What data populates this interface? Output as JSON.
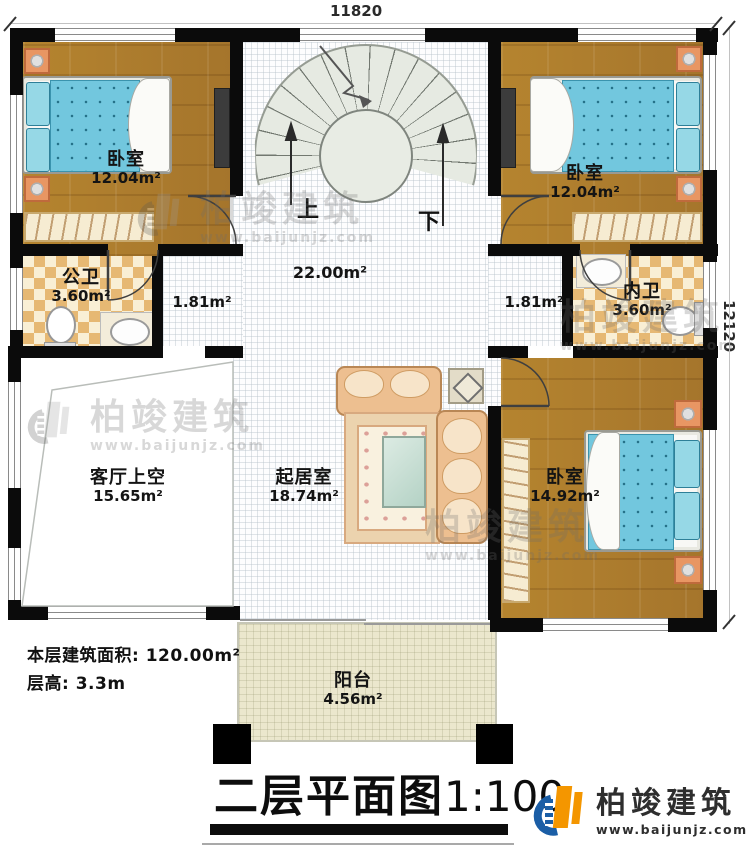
{
  "meta": {
    "dim_top": "11820",
    "dim_right": "12120"
  },
  "rooms": {
    "bedroom_tl": {
      "name": "卧室",
      "area": "12.04m²"
    },
    "bedroom_tr": {
      "name": "卧室",
      "area": "12.04m²"
    },
    "bedroom_br": {
      "name": "卧室",
      "area": "14.92m²"
    },
    "public_bath": {
      "name": "公卫",
      "area": "3.60m²"
    },
    "private_bath": {
      "name": "内卫",
      "area": "3.60m²"
    },
    "living_void": {
      "name": "客厅上空",
      "area": "15.65m²"
    },
    "family_room": {
      "name": "起居室",
      "area": "18.74m²"
    },
    "balcony": {
      "name": "阳台",
      "area": "4.56m²"
    },
    "hall": {
      "area": "22.00m²"
    },
    "corridor_left": {
      "area": "1.81m²"
    },
    "corridor_right": {
      "area": "1.81m²"
    }
  },
  "stairs": {
    "up": "上",
    "down": "下"
  },
  "notes": {
    "line1": "本层建筑面积: 120.00m²",
    "line2": "层高: 3.3m"
  },
  "title": {
    "name": "二层平面图",
    "scale": "1:100"
  },
  "brand": {
    "name": "柏竣建筑",
    "site": "www.baijunjz.com"
  },
  "colors": {
    "wall": "#0b0b0b",
    "accent_blue": "#1b5ea6",
    "accent_orange": "#f49600",
    "wood": "#b1802f",
    "tile": "#e6b873",
    "mattress": "#72c7de"
  }
}
